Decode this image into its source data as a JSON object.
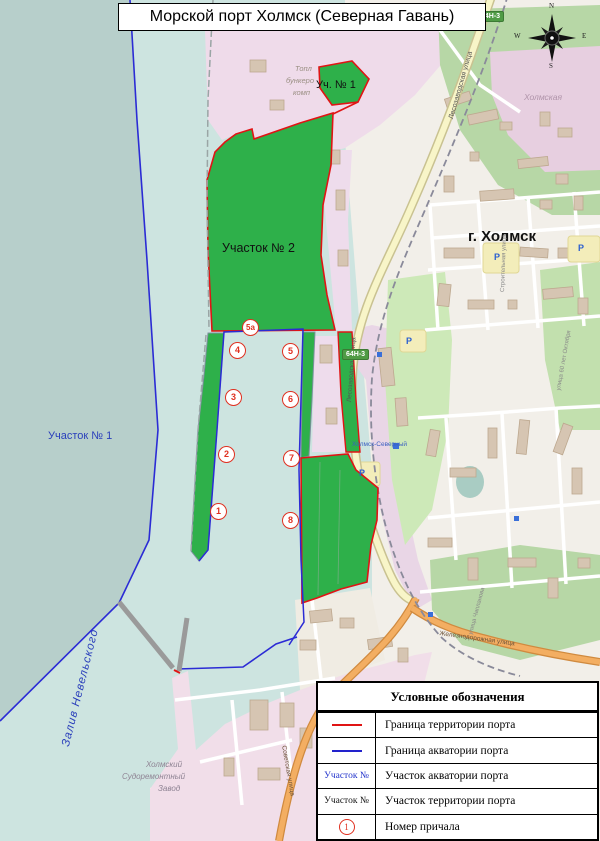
{
  "title": "Морской порт Холмск (Северная Гавань)",
  "colors": {
    "territory_border": "#e01414",
    "water_border": "#2b2bd5",
    "port_area_green": "#2eb04a",
    "outer_sea": "#b7cfcb",
    "harbor_water": "#cde4e0",
    "berth_marker": "#e03020"
  },
  "map": {
    "city_label": "г. Холмск",
    "district_label": "Холмская",
    "bay_label": "Залив Невельского",
    "water_area_label": "Участок № 1",
    "territory_area2_label": "Участок № 2",
    "territory_area1_label": "Уч. № 1",
    "station_label": "Холмск-Северный",
    "road_badge": "64Н-3",
    "parking_letter": "P",
    "shipyard_lines": [
      "Холмский",
      "Судоремонтный",
      "Завод"
    ],
    "fuel_company_lines": [
      "Топл",
      "бункеро",
      "комп"
    ],
    "streets": {
      "lesozavodskaya": "Лесозаводская улица",
      "zheleznodorozhnaya": "Железнодорожная улица",
      "sovetskaya": "Советская улица",
      "stroitelnaya": "Строительная улица",
      "oktyabrya": "улица 60 лет Октября",
      "chaplanova": "улица Чапланова"
    },
    "compass": {
      "n": "N",
      "w": "W",
      "e": "E",
      "s": "S"
    },
    "berths": [
      {
        "label": "1"
      },
      {
        "label": "2"
      },
      {
        "label": "3"
      },
      {
        "label": "4"
      },
      {
        "label": "5"
      },
      {
        "label": "5а"
      },
      {
        "label": "6"
      },
      {
        "label": "7"
      },
      {
        "label": "8"
      }
    ]
  },
  "legend": {
    "title": "Условные обозначения",
    "rows": [
      {
        "text": "Граница территории порта"
      },
      {
        "text": "Граница акватории порта"
      },
      {
        "symbol_text": "Участок №",
        "text": "Участок акватории порта"
      },
      {
        "symbol_text": "Участок №",
        "text": "Участок территории порта"
      },
      {
        "symbol_text": "1",
        "text": "Номер причала"
      }
    ]
  }
}
